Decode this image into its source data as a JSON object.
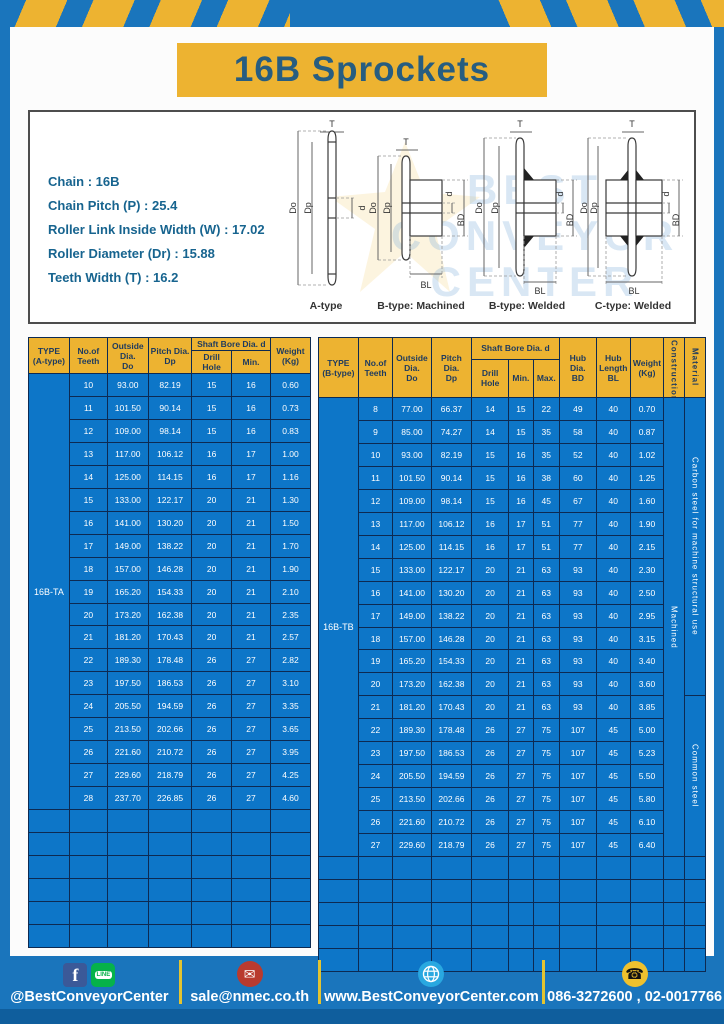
{
  "page": {
    "title": "16B Sprockets"
  },
  "specs": {
    "lines": [
      "Chain : 16B",
      "Chain Pitch (P) : 25.4",
      "Roller Link Inside Width (W) : 17.02",
      "Roller Diameter (Dr) : 15.88",
      "Teeth Width (T) : 16.2"
    ]
  },
  "diagrams": {
    "captions": [
      "A-type",
      "B-type: Machined",
      "B-type: Welded",
      "C-type: Welded"
    ],
    "dims": {
      "T": "T",
      "Do": "Do",
      "Dp": "Dp",
      "d": "d",
      "BD": "BD",
      "BL": "BL"
    },
    "watermark_lines": [
      "BEST",
      "CONVEYOR",
      "CENTER"
    ]
  },
  "table_a": {
    "type": "16B-TA",
    "headers": {
      "type": "TYPE\n(A-type)",
      "teeth": "No.of\nTeeth",
      "outside": "Outside\nDia.\nDo",
      "pitch": "Pitch Dia.\nDp",
      "shaft": "Shaft Bore Dia. d",
      "drill": "Drill Hole",
      "min": "Min.",
      "weight": "Weight\n(Kg)"
    },
    "rows": [
      [
        "10",
        "93.00",
        "82.19",
        "15",
        "16",
        "0.60"
      ],
      [
        "11",
        "101.50",
        "90.14",
        "15",
        "16",
        "0.73"
      ],
      [
        "12",
        "109.00",
        "98.14",
        "15",
        "16",
        "0.83"
      ],
      [
        "13",
        "117.00",
        "106.12",
        "16",
        "17",
        "1.00"
      ],
      [
        "14",
        "125.00",
        "114.15",
        "16",
        "17",
        "1.16"
      ],
      [
        "15",
        "133.00",
        "122.17",
        "20",
        "21",
        "1.30"
      ],
      [
        "16",
        "141.00",
        "130.20",
        "20",
        "21",
        "1.50"
      ],
      [
        "17",
        "149.00",
        "138.22",
        "20",
        "21",
        "1.70"
      ],
      [
        "18",
        "157.00",
        "146.28",
        "20",
        "21",
        "1.90"
      ],
      [
        "19",
        "165.20",
        "154.33",
        "20",
        "21",
        "2.10"
      ],
      [
        "20",
        "173.20",
        "162.38",
        "20",
        "21",
        "2.35"
      ],
      [
        "21",
        "181.20",
        "170.43",
        "20",
        "21",
        "2.57"
      ],
      [
        "22",
        "189.30",
        "178.48",
        "26",
        "27",
        "2.82"
      ],
      [
        "23",
        "197.50",
        "186.53",
        "26",
        "27",
        "3.10"
      ],
      [
        "24",
        "205.50",
        "194.59",
        "26",
        "27",
        "3.35"
      ],
      [
        "25",
        "213.50",
        "202.66",
        "26",
        "27",
        "3.65"
      ],
      [
        "26",
        "221.60",
        "210.72",
        "26",
        "27",
        "3.95"
      ],
      [
        "27",
        "229.60",
        "218.79",
        "26",
        "27",
        "4.25"
      ],
      [
        "28",
        "237.70",
        "226.85",
        "26",
        "27",
        "4.60"
      ]
    ],
    "empty_rows": 6
  },
  "table_b": {
    "type": "16B-TB",
    "headers": {
      "type": "TYPE\n(B-type)",
      "teeth": "No.of\nTeeth",
      "outside": "Outside\nDia.\nDo",
      "pitch": "Pitch Dia.\nDp",
      "shaft": "Shaft Bore Dia. d",
      "drill": "Drill Hole",
      "min": "Min.",
      "max": "Max.",
      "hub_dia": "Hub Dia.\nBD",
      "hub_len": "Hub\nLength\nBL",
      "weight": "Weight\n(Kg)",
      "construction": "Construction",
      "material": "Material"
    },
    "rows": [
      [
        "8",
        "77.00",
        "66.37",
        "14",
        "15",
        "22",
        "49",
        "40",
        "0.70"
      ],
      [
        "9",
        "85.00",
        "74.27",
        "14",
        "15",
        "35",
        "58",
        "40",
        "0.87"
      ],
      [
        "10",
        "93.00",
        "82.19",
        "15",
        "16",
        "35",
        "52",
        "40",
        "1.02"
      ],
      [
        "11",
        "101.50",
        "90.14",
        "15",
        "16",
        "38",
        "60",
        "40",
        "1.25"
      ],
      [
        "12",
        "109.00",
        "98.14",
        "15",
        "16",
        "45",
        "67",
        "40",
        "1.60"
      ],
      [
        "13",
        "117.00",
        "106.12",
        "16",
        "17",
        "51",
        "77",
        "40",
        "1.90"
      ],
      [
        "14",
        "125.00",
        "114.15",
        "16",
        "17",
        "51",
        "77",
        "40",
        "2.15"
      ],
      [
        "15",
        "133.00",
        "122.17",
        "20",
        "21",
        "63",
        "93",
        "40",
        "2.30"
      ],
      [
        "16",
        "141.00",
        "130.20",
        "20",
        "21",
        "63",
        "93",
        "40",
        "2.50"
      ],
      [
        "17",
        "149.00",
        "138.22",
        "20",
        "21",
        "63",
        "93",
        "40",
        "2.95"
      ],
      [
        "18",
        "157.00",
        "146.28",
        "20",
        "21",
        "63",
        "93",
        "40",
        "3.15"
      ],
      [
        "19",
        "165.20",
        "154.33",
        "20",
        "21",
        "63",
        "93",
        "40",
        "3.40"
      ],
      [
        "20",
        "173.20",
        "162.38",
        "20",
        "21",
        "63",
        "93",
        "40",
        "3.60"
      ],
      [
        "21",
        "181.20",
        "170.43",
        "20",
        "21",
        "63",
        "93",
        "40",
        "3.85"
      ],
      [
        "22",
        "189.30",
        "178.48",
        "26",
        "27",
        "75",
        "107",
        "45",
        "5.00"
      ],
      [
        "23",
        "197.50",
        "186.53",
        "26",
        "27",
        "75",
        "107",
        "45",
        "5.23"
      ],
      [
        "24",
        "205.50",
        "194.59",
        "26",
        "27",
        "75",
        "107",
        "45",
        "5.50"
      ],
      [
        "25",
        "213.50",
        "202.66",
        "26",
        "27",
        "75",
        "107",
        "45",
        "5.80"
      ],
      [
        "26",
        "221.60",
        "210.72",
        "26",
        "27",
        "75",
        "107",
        "45",
        "6.10"
      ],
      [
        "27",
        "229.60",
        "218.79",
        "26",
        "27",
        "75",
        "107",
        "45",
        "6.40"
      ]
    ],
    "construction": "Machined",
    "materials": [
      {
        "label": "Carbon steel for machine structural use",
        "rowspan": 13
      },
      {
        "label": "Common steel",
        "rowspan": 7
      }
    ],
    "empty_rows": 5
  },
  "footer": {
    "social": "@BestConveyorCenter",
    "email": "sale@nmec.co.th",
    "website": "www.BestConveyorCenter.com",
    "phone": "086-3272600 , 02-0017766"
  },
  "colors": {
    "frame_blue": "#1a75bc",
    "accent_yellow": "#edb331",
    "cell_blue": "#0d76c8",
    "border_navy": "#0d2a52",
    "title_teal": "#275d80"
  }
}
